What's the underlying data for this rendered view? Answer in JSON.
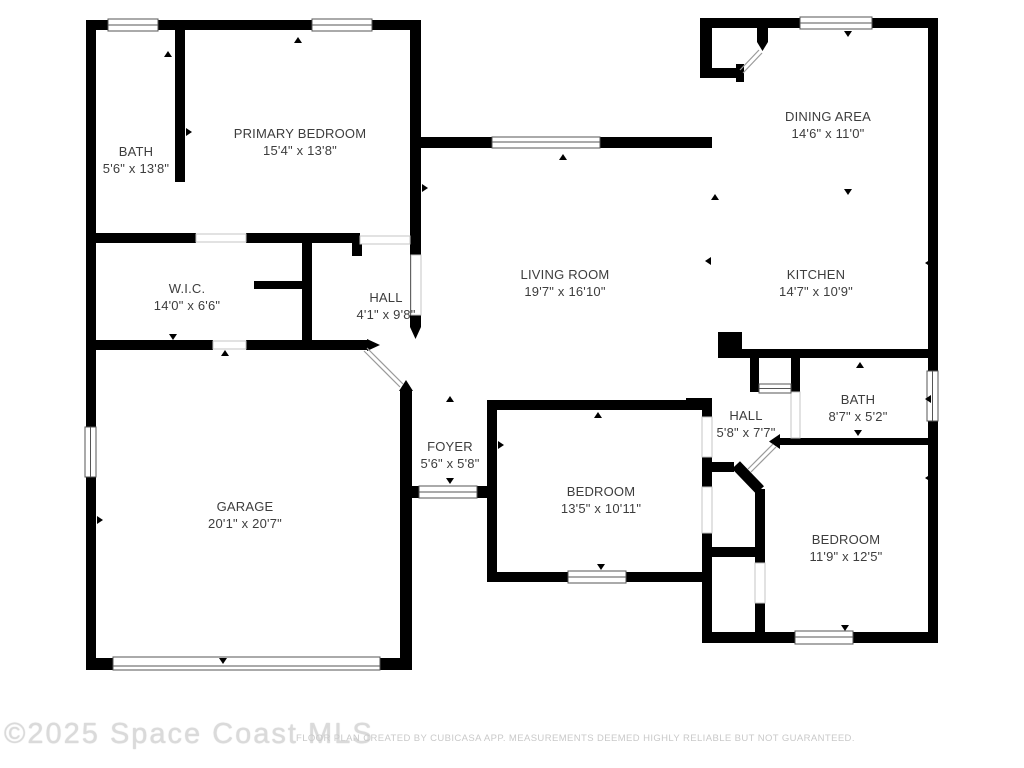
{
  "rooms": [
    {
      "name": "BATH",
      "dims": "5'6\" x 13'8\""
    },
    {
      "name": "PRIMARY BEDROOM",
      "dims": "15'4\" x 13'8\""
    },
    {
      "name": "DINING AREA",
      "dims": "14'6\" x 11'0\""
    },
    {
      "name": "W.I.C.",
      "dims": "14'0\" x 6'6\""
    },
    {
      "name": "HALL",
      "dims": "4'1\" x 9'8\""
    },
    {
      "name": "LIVING ROOM",
      "dims": "19'7\" x 16'10\""
    },
    {
      "name": "KITCHEN",
      "dims": "14'7\" x 10'9\""
    },
    {
      "name": "GARAGE",
      "dims": "20'1\" x 20'7\""
    },
    {
      "name": "FOYER",
      "dims": "5'6\" x 5'8\""
    },
    {
      "name": "BEDROOM",
      "dims": "13'5\" x 10'11\""
    },
    {
      "name": "HALL",
      "dims": "5'8\" x 7'7\""
    },
    {
      "name": "BATH",
      "dims": "8'7\" x 5'2\""
    },
    {
      "name": "BEDROOM",
      "dims": "11'9\" x 12'5\""
    }
  ],
  "footer": {
    "watermark": "©2025 Space Coast MLS",
    "disclaimer": "FLOOR PLAN CREATED BY CUBICASA APP. MEASUREMENTS DEEMED HIGHLY RELIABLE BUT NOT GUARANTEED."
  },
  "colors": {
    "wall": "#000000",
    "window_frame": "#555555",
    "door_guide": "#c4c4c4",
    "label_text": "#3d3d3d",
    "watermark_text": "#dadada"
  }
}
